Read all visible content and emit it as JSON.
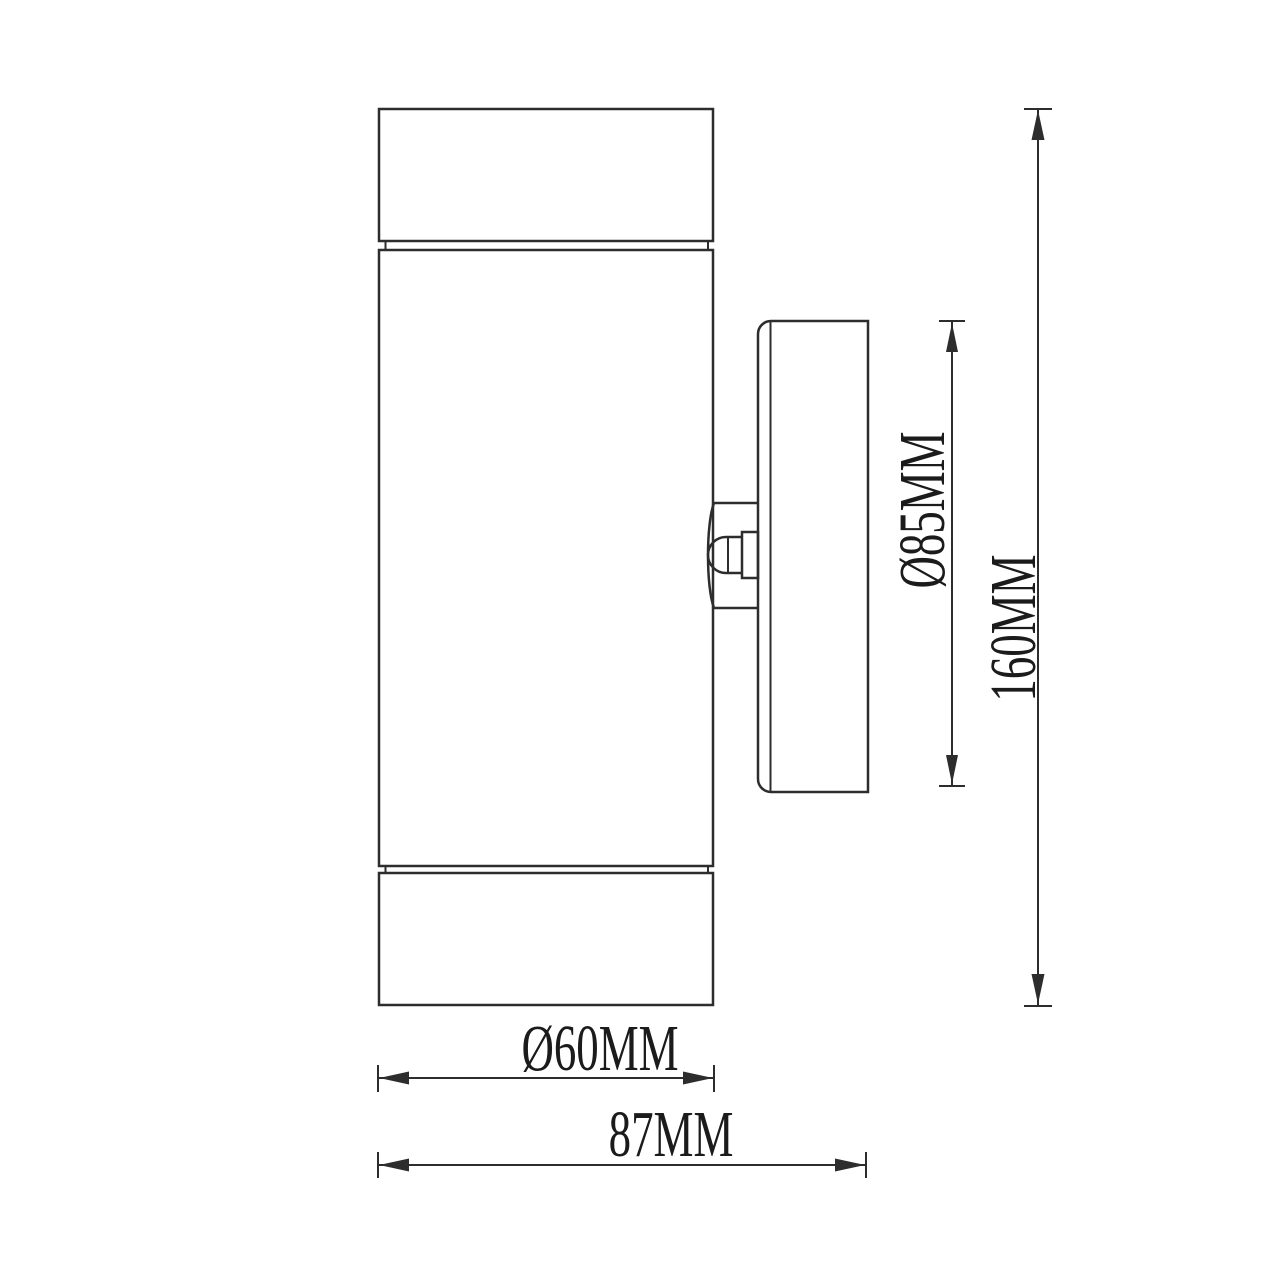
{
  "drawing": {
    "description": "Side elevation technical dimension drawing of a cylindrical up/down wall light with a round wall mounting plate and adjustment knob",
    "background_color": "#ffffff",
    "line_color": "#2d2d2d",
    "text_color": "#1b1b1b",
    "labels": {
      "cylinder_diameter": "Ø60MM",
      "overall_depth": "87MM",
      "wall_plate_diameter": "Ø85MM",
      "overall_height": "160MM"
    }
  }
}
